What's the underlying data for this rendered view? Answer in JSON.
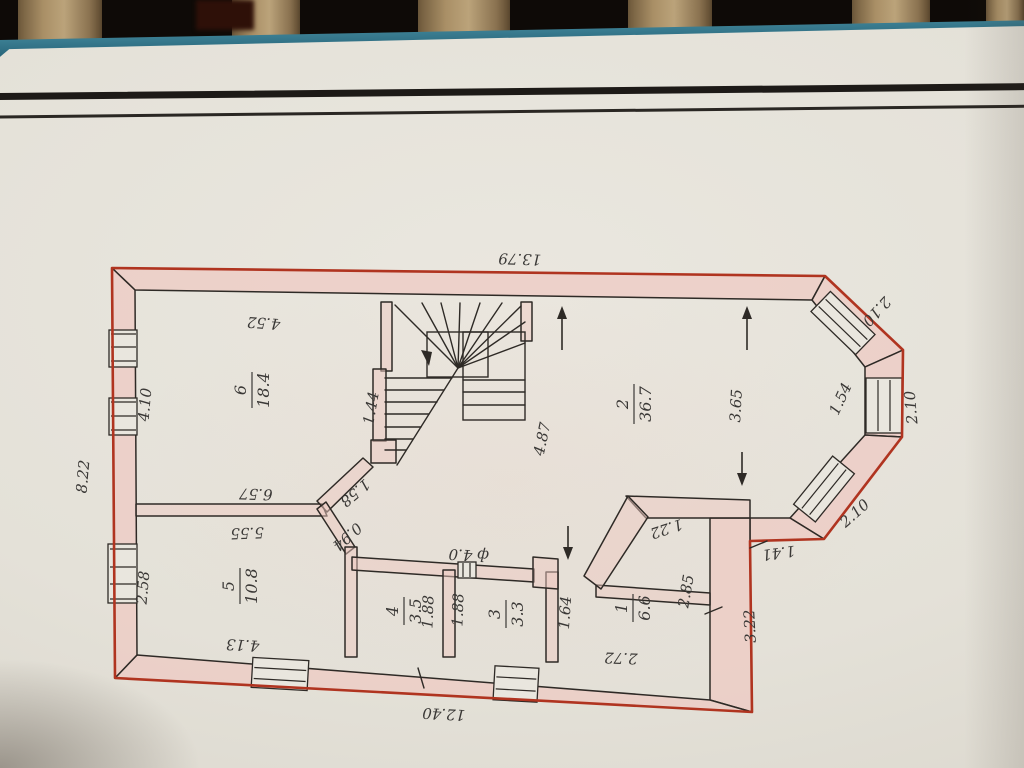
{
  "colors": {
    "paper": "#e4e1d8",
    "wall_fill_pink": "#eec9c2",
    "outline_red": "#b03420",
    "ink": "#2e2a26",
    "folder_edge_teal": "#266378",
    "wood_slat": "#a98f66",
    "background": "#0e0a07"
  },
  "plan": {
    "rooms": {
      "r1": {
        "number": "1",
        "area": "6.6"
      },
      "r2": {
        "number": "2",
        "area": "36.7"
      },
      "r3": {
        "number": "3",
        "area": "3.3"
      },
      "r4": {
        "number": "4",
        "area": "3.5"
      },
      "r5": {
        "number": "5",
        "area": "10.8"
      },
      "r6": {
        "number": "6",
        "area": "18.4"
      }
    },
    "dims": {
      "overall_top": "13.79",
      "overall_bottom": "12.40",
      "overall_left": "8.22",
      "room6_top": "4.52",
      "room6_left": "4.10",
      "wall56_upper": "6.57",
      "wall56_lower": "5.55",
      "stair_niche": "1.44",
      "hall_diag": "1.58",
      "door_diag": "0.94",
      "room5_left": "2.58",
      "room5_bottom": "4.13",
      "room4_left": "1.88",
      "room4_right": "1.88",
      "flue": "ф 4.0",
      "lobby_width": "1.64",
      "room1_bottom": "2.72",
      "room1_right": "2.85",
      "right_lower": "3.22",
      "right_notch": "1.41",
      "bay_upper": "2.10",
      "bay_right_outer": "2.10",
      "bay_right_inner": "1.54",
      "bay_lower": "2.10",
      "room2_width": "3.65",
      "hall_length": "4.87",
      "room1_diag": "1.22"
    }
  }
}
